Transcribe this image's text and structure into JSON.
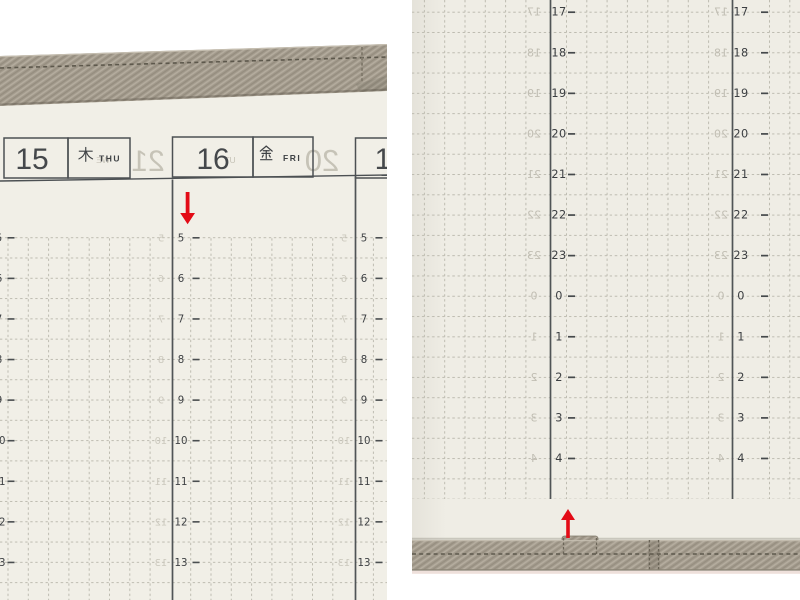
{
  "left_photo": {
    "label": "planner weekly page, top edge with fabric cover and date headers",
    "days": [
      {
        "number": "15",
        "kanji": "木",
        "weekday": "THU"
      },
      {
        "number": "16",
        "kanji": "金",
        "weekday": "FRI"
      },
      {
        "number": "1",
        "kanji": "",
        "weekday": ""
      }
    ],
    "hours": [
      "5",
      "6",
      "7",
      "8",
      "9",
      "10",
      "11",
      "12",
      "13"
    ],
    "ghost_showthrough": [
      "21",
      "20",
      "WE",
      "UT"
    ],
    "arrow": {
      "direction": "down",
      "color": "#e30b16"
    }
  },
  "right_photo": {
    "label": "planner weekly page, bottom timeline with fabric cover edge",
    "hours": [
      "17",
      "18",
      "19",
      "20",
      "21",
      "22",
      "23",
      "0",
      "1",
      "2",
      "3",
      "4"
    ],
    "arrow": {
      "direction": "up",
      "color": "#e30b16"
    }
  },
  "colors": {
    "background": "#ffffff",
    "paper": "#f1efe7",
    "fabric": "#a29a8c",
    "grid_dots": "#bdbbb0",
    "solid_line": "#505456",
    "hour_text": "#3e4144",
    "accent_red": "#e30b16"
  }
}
